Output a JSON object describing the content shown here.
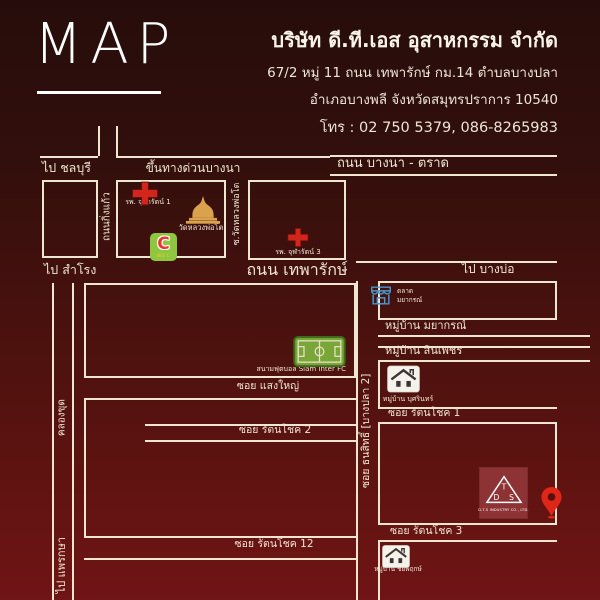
{
  "header": {
    "title": "MAP",
    "company_name": "บริษัท ดี.ที.เอส อุสาหกรรม จำกัด",
    "address_line1": "67/2 หมู่ 11 ถนน เทพารักษ์ กม.14 ตำบลบางปลา",
    "address_line2": "อำเภอบางพลี จังหวัดสมุทรปราการ 10540",
    "phone": "โทร : 02 750 5379, 086-8265983"
  },
  "roads": {
    "to_chonburi": "ไป ชลบุรี",
    "expressway_bangna": "ขึ้นทางด่วนบางนา",
    "bangna_trad": "ถนน บางนา - ตราด",
    "king_kaew": "ถนนกิ่งแก้ว",
    "soi_wat_luang_pho_to": "ซ.วัดหลวงพ่อโต",
    "to_samrong": "ไป สำโรง",
    "thepharak": "ถนน เทพารักษ์",
    "to_bang_bo": "ไป บางบ่อ",
    "khlong_khut": "คลองขุด",
    "to_phraeksa": "ไป แพรกษา",
    "soi_saeng_yai": "ซอย แสงใหญ่",
    "soi_thanasit": "ซอย ธนสิทธิ์ [บางปลา 2]",
    "soi_rattanachok_1": "ซอย รัตนโชค 1",
    "soi_rattanachok_2": "ซอย รัตนโชค 2",
    "soi_rattanachok_3": "ซอย รัตนโชค 3",
    "soi_rattanachok_12": "ซอย รัตนโชค 12"
  },
  "places": {
    "hospital_chularat_1": "รพ. จุฬารัตน์ 1",
    "hospital_chularat_3": "รพ. จุฬารัตน์ 3",
    "temple_wat_luang_pho_to": "วัดหลวงพ่อโต",
    "big_c_letter": "C",
    "big_c_sub": "BIG C",
    "market_line1": "ตลาด",
    "market_line2": "มยากรณ์",
    "village_mayakorn": "หมู่บ้าน มยากรณ์",
    "village_sin_phet": "หมู่บ้าน สินเพชร",
    "village_butsarin": "หมู่บ้าน บุศรินทร์",
    "village_chaiyapruek": "หมู่บ้าน ชัยพฤกษ์",
    "football_field": "สนามฟุตบอล Siam Inter FC",
    "dts_letter_d": "D",
    "dts_letter_t": "T",
    "dts_letter_s": "S",
    "dts_caption": "D.T.S INDUSTRY CO., LTD."
  },
  "colors": {
    "background_top": "#260d0b",
    "background_bottom": "#701416",
    "line_cream": "#efe6d1",
    "red_cross": "#d2251c",
    "temple_gold": "#dba24d",
    "big_c_green": "#8ec63f",
    "market_blue": "#4796cc",
    "pitch_green": "#79a737",
    "dts_red": "#8d3336",
    "pin_red": "#e02619"
  }
}
